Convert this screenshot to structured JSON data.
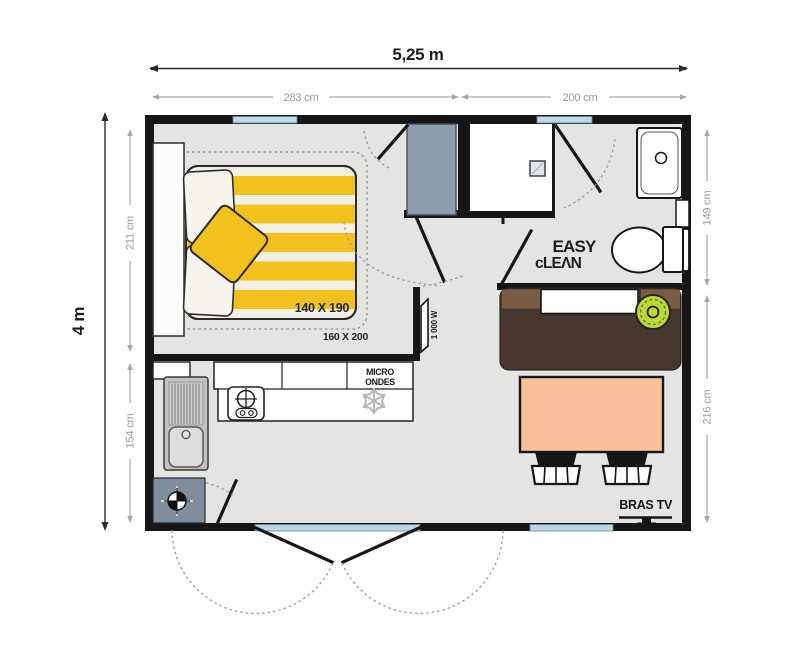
{
  "plan": {
    "dims": {
      "width_total": "5,25 m",
      "width_seg_left": "283 cm",
      "width_seg_right": "200 cm",
      "height_total": "4 m",
      "height_seg_left_top": "211 cm",
      "height_seg_left_bottom": "154 cm",
      "height_seg_right_top": "149 cm",
      "height_seg_right_bottom": "216 cm"
    },
    "labels": {
      "mattress_size": "140 X 190",
      "bed_size": "160 X 200",
      "heater_power": "1 000 W",
      "microwave_line1": "MICRO",
      "microwave_line2": "ONDES",
      "logo_line1": "EASY",
      "logo_line2": "cLEΛN",
      "tv_bracket": "BRAS TV"
    },
    "colors": {
      "wall": "#161616",
      "floor": "#e4e4e3",
      "window_glass": "#bed7e8",
      "bed_yellow": "#f2c11d",
      "bench_dark_brown": "#46382f",
      "bench_light_brown": "#7b5c45",
      "table_salmon": "#f8c19b",
      "pouf_green": "#bcd937",
      "wardrobe_gray": "#8d9cab",
      "heater_box_gray": "#7e8e9b",
      "dimension_gray": "#9a9a9a",
      "mattress_text": "#1b2531"
    },
    "icons": {
      "snowflake": "fridge-freezer",
      "burner": "gas-hob",
      "crosshair_marker": "water-heater",
      "shower_drain": "shower",
      "tv_mount": "tv-bracket"
    }
  }
}
